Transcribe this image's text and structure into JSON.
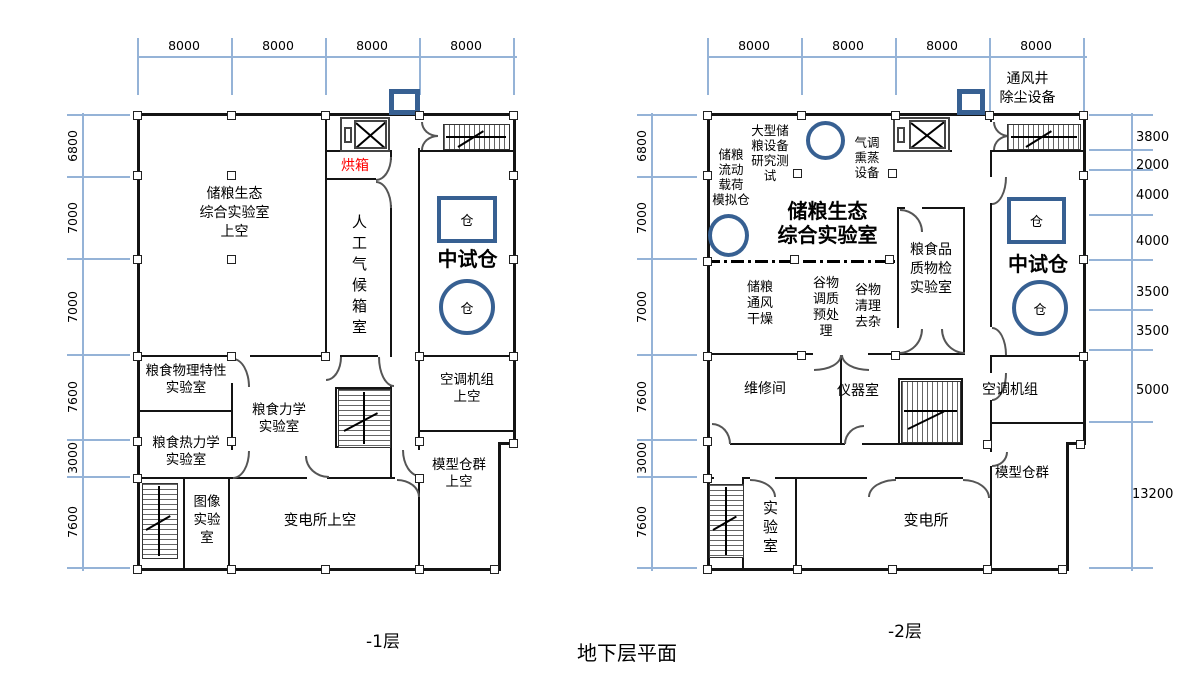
{
  "title": "地下层平面",
  "colors": {
    "wall": "#141414",
    "dimension_line": "#95b3d7",
    "accent_blue": "#376092",
    "highlight_red": "#ff0000"
  },
  "plans": {
    "left": {
      "caption": "-1层",
      "top_dims": [
        "8000",
        "8000",
        "8000",
        "8000"
      ],
      "left_dims": [
        "6800",
        "7000",
        "7000",
        "7600",
        "3000",
        "7600"
      ],
      "rooms": {
        "grain_ecology_upper": "储粮生态\n综合实验室\n上空",
        "oven": "烘箱",
        "artificial_climate": "人工气候箱室",
        "pilot_silo": "中试仓",
        "silo_square": "仓",
        "silo_circle": "仓",
        "grain_physical": "粮食物理特性\n实验室",
        "grain_mechanics": "粮食力学\n实验室",
        "grain_thermal": "粮食热力学\n实验室",
        "image_lab": "图像\n实验\n室",
        "substation_upper": "变电所上空",
        "hvac_upper": "空调机组\n上空",
        "model_silos_upper": "模型仓群\n上空"
      }
    },
    "right": {
      "caption": "-2层",
      "top_dims": [
        "8000",
        "8000",
        "8000",
        "8000"
      ],
      "left_dims": [
        "6800",
        "7000",
        "7000",
        "7600",
        "3000",
        "7600"
      ],
      "right_dims": [
        "3800",
        "2000",
        "4000",
        "4000",
        "3500",
        "3500",
        "5000",
        "13200"
      ],
      "rooms": {
        "vent_shaft": "通风井\n除尘设备",
        "large_equipment": "大型储\n粮设备\n研究测\n试",
        "flow_load_silo": "储粮\n流动\n载荷\n模拟仓",
        "fumigation": "气调\n熏蒸\n设备",
        "grain_ecology": "储粮生态\n综合实验室",
        "quality_inspection": "粮食品\n质物检\n实验室",
        "pilot_silo": "中试仓",
        "silo_square": "仓",
        "silo_circle": "仓",
        "ventilation_drying": "储粮\n通风\n干燥",
        "grain_conditioning": "谷物\n调质\n预处\n理",
        "grain_cleaning": "谷物\n清理\n去杂",
        "maintenance_room": "维修间",
        "instrument_room": "仪器室",
        "hvac": "空调机组",
        "model_silos": "模型仓群",
        "lab": "实验室",
        "substation": "变电所"
      }
    }
  }
}
